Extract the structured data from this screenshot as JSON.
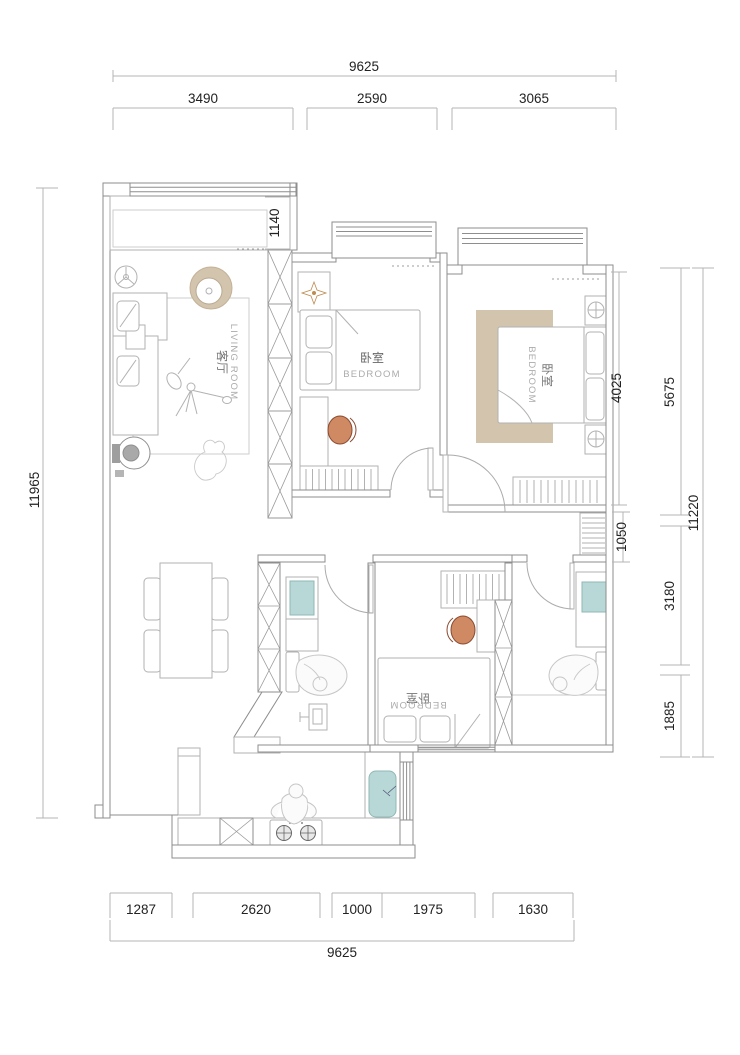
{
  "rooms": {
    "living": {
      "zh": "客厅",
      "en": "LIVING ROOM"
    },
    "bedroom_top": {
      "zh": "卧室",
      "en": "BEDROOM"
    },
    "bedroom_master": {
      "zh": "卧室",
      "en": "BEDROOM"
    },
    "bedroom_bottom": {
      "zh": "卧室",
      "en": "BEDROOM"
    }
  },
  "dimensions": {
    "top_total": "9625",
    "top_segments": [
      "3490",
      "2590",
      "3065"
    ],
    "bottom_segments": [
      "1287",
      "2620",
      "1000",
      "1975",
      "1630"
    ],
    "bottom_total": "9625",
    "left_total": "11965",
    "right_segments": [
      "5675",
      "3180",
      "1885"
    ],
    "right_total": "11220",
    "interior": {
      "balcony_depth": "1140",
      "master_length": "4025",
      "cabinet": "1050"
    }
  },
  "colors": {
    "tan": "#d2c4ad",
    "teal": "#b7d8d6",
    "orange": "#d08a63",
    "wall": "#8e8e8e"
  }
}
